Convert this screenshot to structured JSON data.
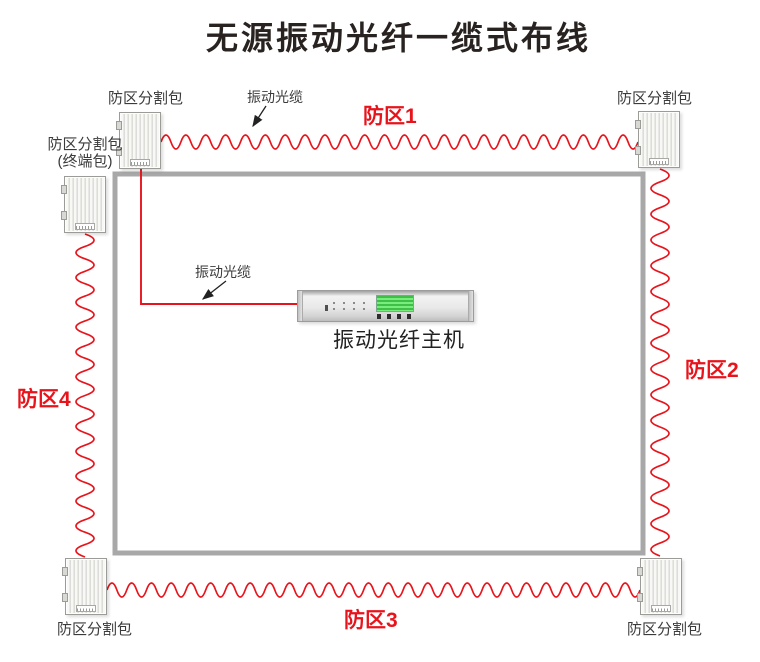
{
  "title": "无源振动光纤一缆式布线",
  "colors": {
    "cable_red": "#e8141c",
    "zone_red": "#e8141c",
    "frame_gray": "#a8a8a8",
    "ink": "#282220",
    "label_ink": "#3b3b3b"
  },
  "diagram": {
    "zones": [
      {
        "id": "zone1",
        "label": "防区1"
      },
      {
        "id": "zone2",
        "label": "防区2"
      },
      {
        "id": "zone3",
        "label": "防区3"
      },
      {
        "id": "zone4",
        "label": "防区4"
      }
    ],
    "splitter_label": "防区分割包",
    "terminal_label_line1": "防区分割包",
    "terminal_label_line2": "(终端包)",
    "cable_label": "振动光缆",
    "host_label": "振动光纤主机"
  }
}
